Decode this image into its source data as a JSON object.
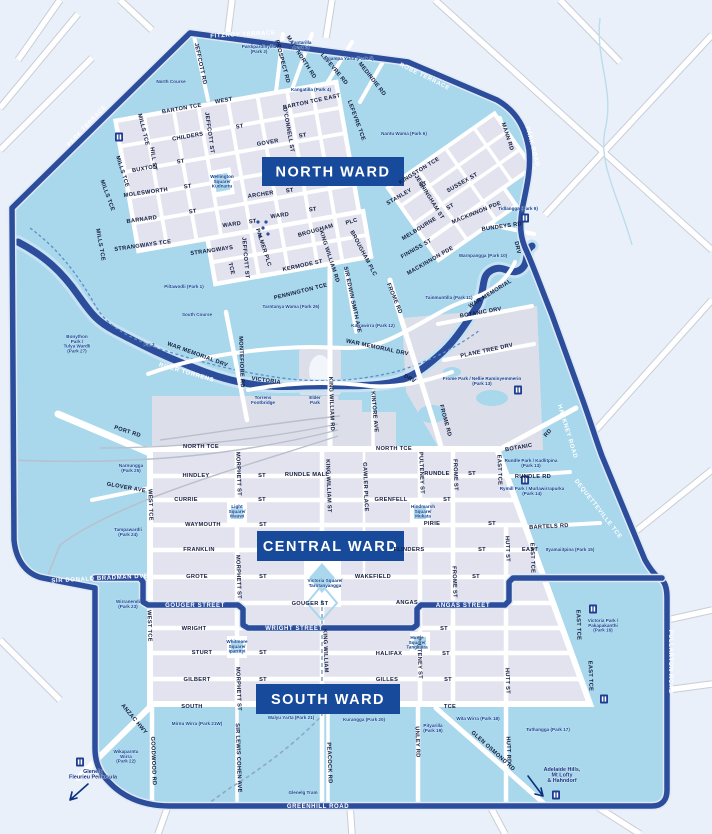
{
  "map": {
    "colors": {
      "outside": "#e9f0f9",
      "parkland": "#a9d7ec",
      "block": "#e2e3ee",
      "infra_grey": "#dcdfe9",
      "boundary_navy": "#2b4d9b",
      "banner_navy": "#174a9b",
      "water_light": "#c6e2f3",
      "label_dark": "#131c3e",
      "park_label": "#0d3e8f"
    },
    "banners": [
      {
        "id": "north",
        "label": "NORTH WARD",
        "x": 262,
        "y": 157,
        "w": 142,
        "h": 29
      },
      {
        "id": "central",
        "label": "CENTRAL WARD",
        "x": 257,
        "y": 531,
        "w": 147,
        "h": 30
      },
      {
        "id": "south",
        "label": "SOUTH WARD",
        "x": 256,
        "y": 684,
        "w": 144,
        "h": 30
      }
    ],
    "boundary_labels": [
      [
        "FITZROY TERRACE",
        243,
        36,
        -3
      ],
      [
        "ROBE TERRACE",
        424,
        78,
        26
      ],
      [
        "PARK ROAD",
        531,
        147,
        75
      ],
      [
        "HACKNEY ROAD",
        566,
        432,
        73
      ],
      [
        "DEQUETTEVILLE TCE",
        597,
        510,
        52
      ],
      [
        "FULLARTON ROAD",
        669,
        662,
        90
      ],
      [
        "GREENHILL ROAD",
        318,
        808,
        0
      ],
      [
        "PARK TERRACE",
        88,
        127,
        -47
      ],
      [
        "SIR DONALD BRADMAN DVE",
        100,
        580,
        -3
      ],
      [
        "GOUGER STREET",
        195,
        607,
        0
      ],
      [
        "WRIGHT STREET",
        294,
        630,
        0
      ],
      [
        "ANGAS STREET",
        463,
        607,
        0
      ],
      [
        "RIVER TORRENS",
        186,
        374,
        16
      ]
    ],
    "streets": [
      [
        "JEFFCOTT RD",
        199,
        64,
        78
      ],
      [
        "PROSPECT RD",
        281,
        62,
        75
      ],
      [
        "MAIN NORTH RD",
        300,
        58,
        57
      ],
      [
        "LEFEVRE RD",
        333,
        70,
        50
      ],
      [
        "MEDINDIE RD",
        371,
        80,
        52
      ],
      [
        "LEFEVRE TCE",
        355,
        121,
        70
      ],
      [
        "BARTON TCE",
        182,
        110,
        -10
      ],
      [
        "WEST",
        224,
        102,
        -10
      ],
      [
        "BARTON TCE EAST",
        312,
        103,
        -12
      ],
      [
        "CHILDERS",
        188,
        138,
        -10
      ],
      [
        "ST",
        240,
        128,
        -10
      ],
      [
        "GOVER",
        268,
        144,
        -10
      ],
      [
        "ST",
        303,
        137,
        -10
      ],
      [
        "O'CONNELL ST",
        287,
        130,
        80
      ],
      [
        "MILLS TCE",
        142,
        130,
        76
      ],
      [
        "HILL ST",
        152,
        159,
        82
      ],
      [
        "MILLS TCE",
        121,
        172,
        72
      ],
      [
        "MILLS TCE",
        106,
        196,
        70
      ],
      [
        "MILLS TCE",
        99,
        245,
        80
      ],
      [
        "BUXTON",
        145,
        170,
        -10
      ],
      [
        "ST",
        181,
        163,
        -10
      ],
      [
        "MOLESWORTH",
        146,
        194,
        -8
      ],
      [
        "ST",
        188,
        188,
        -8
      ],
      [
        "ARCHER",
        261,
        196,
        -8
      ],
      [
        "ST",
        290,
        192,
        -8
      ],
      [
        "BARNARD",
        142,
        221,
        -8
      ],
      [
        "ST",
        193,
        213,
        -8
      ],
      [
        "WARD",
        232,
        226,
        -8
      ],
      [
        "ST",
        253,
        223,
        -8
      ],
      [
        "WARD",
        280,
        217,
        -8
      ],
      [
        "ST",
        313,
        211,
        -8
      ],
      [
        "STRANGWAYS TCE",
        143,
        247,
        -8
      ],
      [
        "STRANGWAYS",
        212,
        252,
        -8
      ],
      [
        "TCE",
        230,
        269,
        75
      ],
      [
        "JEFFCOTT ST",
        208,
        133,
        82
      ],
      [
        "JEFFCOTT ST",
        244,
        258,
        85
      ],
      [
        "PALMER PLC",
        262,
        248,
        72
      ],
      [
        "BROUGHAM",
        316,
        232,
        -16
      ],
      [
        "PLC",
        352,
        223,
        -16
      ],
      [
        "BROUGHAM PLC",
        362,
        254,
        62
      ],
      [
        "KING WILLIAM RD",
        328,
        257,
        72
      ],
      [
        "KERMODE ST",
        303,
        267,
        -12
      ],
      [
        "PENNINGTON TCE",
        301,
        293,
        -14
      ],
      [
        "SIR EDWIN SMITH AVE",
        351,
        300,
        78
      ],
      [
        "FROME RD",
        393,
        299,
        68
      ],
      [
        "FROME RD",
        444,
        421,
        75
      ],
      [
        "KINGSTON TCE",
        420,
        172,
        -32
      ],
      [
        "STANLEY",
        400,
        198,
        -30
      ],
      [
        "ST",
        424,
        186,
        -30
      ],
      [
        "JERNINGHAM ST",
        428,
        198,
        58
      ],
      [
        "SUSSEX ST",
        463,
        184,
        -30
      ],
      [
        "MELBOURNE",
        420,
        230,
        -32
      ],
      [
        "ST",
        451,
        208,
        -30
      ],
      [
        "FINNISS ST",
        417,
        250,
        -30
      ],
      [
        "MACKINNON PDE",
        477,
        214,
        -22
      ],
      [
        "MACKINNON PDE",
        431,
        262,
        -30
      ],
      [
        "BUNDEYS RD",
        502,
        228,
        -8
      ],
      [
        "MANN RD",
        506,
        137,
        72
      ],
      [
        "DRV",
        516,
        248,
        78
      ],
      [
        "WAR MEMORIAL",
        491,
        295,
        -32
      ],
      [
        "WAR MEMORIAL DRV",
        197,
        356,
        20
      ],
      [
        "WAR MEMORIAL DRV",
        377,
        349,
        12
      ],
      [
        "MONTEFIORE RD",
        240,
        362,
        88
      ],
      [
        "KING WILLIAM RD",
        330,
        404,
        88
      ],
      [
        "KINTORE AVE",
        373,
        412,
        85
      ],
      [
        "VICTORIA",
        266,
        382,
        8
      ],
      [
        "DRV",
        409,
        380,
        28
      ],
      [
        "BOTANIC DRV",
        481,
        314,
        -10
      ],
      [
        "PLANE TREE DRV",
        487,
        352,
        -12
      ],
      [
        "BOTANIC",
        519,
        449,
        -10
      ],
      [
        "RD",
        549,
        434,
        -50
      ],
      [
        "PORT RD",
        127,
        433,
        18
      ],
      [
        "GLOVER AVE",
        126,
        489,
        10
      ],
      [
        "NORTH TCE",
        201,
        448,
        0
      ],
      [
        "NORTH TCE",
        394,
        450,
        0
      ],
      [
        "HINDLEY",
        196,
        477,
        0
      ],
      [
        "ST",
        262,
        477,
        0
      ],
      [
        "RUNDLE MALL",
        307,
        476,
        0
      ],
      [
        "RUNDLE",
        437,
        475,
        0
      ],
      [
        "ST",
        472,
        475,
        0
      ],
      [
        "RUNDLE RD",
        533,
        478,
        0
      ],
      [
        "CURRIE",
        186,
        501,
        0
      ],
      [
        "ST",
        262,
        501,
        0
      ],
      [
        "GRENFELL",
        391,
        501,
        0
      ],
      [
        "ST",
        447,
        501,
        0
      ],
      [
        "WAYMOUTH",
        203,
        526,
        0
      ],
      [
        "ST",
        263,
        526,
        0
      ],
      [
        "PIRIE",
        432,
        525,
        0
      ],
      [
        "ST",
        492,
        525,
        0
      ],
      [
        "FRANKLIN",
        199,
        551,
        0
      ],
      [
        "FLINDERS",
        409,
        551,
        0
      ],
      [
        "ST",
        482,
        551,
        0
      ],
      [
        "EAST",
        530,
        551,
        0
      ],
      [
        "GROTE",
        197,
        578,
        0
      ],
      [
        "ST",
        263,
        578,
        0
      ],
      [
        "WAKEFIELD",
        373,
        578,
        0
      ],
      [
        "ST",
        476,
        578,
        0
      ],
      [
        "GOUGER ST",
        310,
        605,
        0
      ],
      [
        "ANGAS",
        407,
        604,
        0
      ],
      [
        "WRIGHT",
        194,
        630,
        0
      ],
      [
        "ST",
        444,
        630,
        0
      ],
      [
        "STURT",
        202,
        654,
        0
      ],
      [
        "ST",
        263,
        654,
        0
      ],
      [
        "HALIFAX",
        389,
        655,
        0
      ],
      [
        "ST",
        446,
        655,
        0
      ],
      [
        "GILBERT",
        197,
        681,
        0
      ],
      [
        "ST",
        263,
        681,
        0
      ],
      [
        "GILLES",
        387,
        681,
        0
      ],
      [
        "ST",
        448,
        681,
        0
      ],
      [
        "SOUTH",
        192,
        708,
        0
      ],
      [
        "TCE",
        450,
        708,
        0
      ],
      [
        "WEST TCE",
        149,
        505,
        88
      ],
      [
        "WEST TCE",
        148,
        626,
        88
      ],
      [
        "MORPHETT ST",
        237,
        474,
        88
      ],
      [
        "MORPHETT ST",
        237,
        577,
        88
      ],
      [
        "MORPHETT ST",
        237,
        689,
        88
      ],
      [
        "KING WILLIAM ST",
        327,
        486,
        88
      ],
      [
        "KING WILLIAM",
        324,
        651,
        88
      ],
      [
        "GAWLER PLACE",
        364,
        487,
        88
      ],
      [
        "PULTENEY ST",
        420,
        473,
        88
      ],
      [
        "PULTENEY ST",
        418,
        658,
        88
      ],
      [
        "FROME ST",
        454,
        475,
        88
      ],
      [
        "FROME ST",
        453,
        582,
        88
      ],
      [
        "EAST TCE",
        498,
        470,
        88
      ],
      [
        "EAST TCE",
        531,
        558,
        88
      ],
      [
        "EAST TCE",
        577,
        625,
        88
      ],
      [
        "EAST TCE",
        589,
        676,
        88
      ],
      [
        "HUTT ST",
        506,
        549,
        88
      ],
      [
        "HUTT ST",
        506,
        681,
        88
      ],
      [
        "HUTT RD",
        507,
        750,
        88
      ],
      [
        "UNLEY RD",
        416,
        742,
        88
      ],
      [
        "GLEN OSMOND RD",
        492,
        752,
        42
      ],
      [
        "PEACOCK RD",
        328,
        763,
        88
      ],
      [
        "SIR LEWIS COHEN AVE",
        237,
        758,
        88
      ],
      [
        "GOODWOOD RD",
        152,
        761,
        88
      ],
      [
        "ANZAC HWY",
        133,
        720,
        50
      ],
      [
        "BARTELS RD",
        549,
        528,
        -3
      ]
    ],
    "parks": [
      {
        "lines": [
          "Pardipardinyilla",
          "(Park 2)"
        ],
        "x": 259,
        "y": 48
      },
      {
        "lines": [
          "Kantarilla",
          "(Park 3)"
        ],
        "x": 301,
        "y": 44
      },
      {
        "lines": [
          "Ngampa Yarta (Park 5)"
        ],
        "x": 349,
        "y": 60
      },
      {
        "lines": [
          "Kangatilla (Park 4)"
        ],
        "x": 311,
        "y": 91
      },
      {
        "lines": [
          "North Course"
        ],
        "x": 171,
        "y": 83
      },
      {
        "lines": [
          "Nantu Wama (Park 6)"
        ],
        "x": 404,
        "y": 135
      },
      {
        "lines": [
          "Tidlangga (Park 9)"
        ],
        "x": 518,
        "y": 210
      },
      {
        "lines": [
          "Warnpangga (Park 10)"
        ],
        "x": 483,
        "y": 257
      },
      {
        "lines": [
          "Piltawodli (Park 1)"
        ],
        "x": 184,
        "y": 288
      },
      {
        "lines": [
          "South Course"
        ],
        "x": 197,
        "y": 316
      },
      {
        "lines": [
          "Bonython",
          "Park /",
          "Tulya Wardli",
          "(Park 27)"
        ],
        "x": 77,
        "y": 338
      },
      {
        "lines": [
          "Par 3"
        ],
        "x": 149,
        "y": 346
      },
      {
        "lines": [
          "Tarntanya Wama (Park 26)"
        ],
        "x": 291,
        "y": 308
      },
      {
        "lines": [
          "Elder",
          "Park"
        ],
        "x": 315,
        "y": 399
      },
      {
        "lines": [
          "Torrens",
          "Footbridge"
        ],
        "x": 263,
        "y": 399
      },
      {
        "lines": [
          "Karrawirra (Park 12)"
        ],
        "x": 373,
        "y": 327
      },
      {
        "lines": [
          "Tainmuntilla (Park 11)"
        ],
        "x": 449,
        "y": 299
      },
      {
        "lines": [
          "Frome Park / Nellie Raminyemmerin",
          "(Park 13)"
        ],
        "x": 482,
        "y": 380
      },
      {
        "lines": [
          "Rundle Park / Kadlitpina",
          "(Park 13)"
        ],
        "x": 531,
        "y": 462
      },
      {
        "lines": [
          "Rymill Park / Murlawirrapurka",
          "(Park 14)"
        ],
        "x": 532,
        "y": 490
      },
      {
        "lines": [
          "Ityamaiitpina (Park 15)"
        ],
        "x": 570,
        "y": 551
      },
      {
        "lines": [
          "Victoria Park /",
          "Pakapakanthi",
          "(Park 16)"
        ],
        "x": 603,
        "y": 622
      },
      {
        "lines": [
          "Narnungga",
          "(Park 25)"
        ],
        "x": 131,
        "y": 467
      },
      {
        "lines": [
          "Tampawardli",
          "(Park 24)"
        ],
        "x": 128,
        "y": 531
      },
      {
        "lines": [
          "Wirranendi",
          "(Park 23)"
        ],
        "x": 128,
        "y": 603
      },
      {
        "lines": [
          "Mirnu Wirra (Park 21W)"
        ],
        "x": 197,
        "y": 725
      },
      {
        "lines": [
          "Walyu Yarta (Park 21)"
        ],
        "x": 291,
        "y": 719
      },
      {
        "lines": [
          "Kurangga (Park 20)"
        ],
        "x": 364,
        "y": 721
      },
      {
        "lines": [
          "Pityarilla",
          "(Park 19)"
        ],
        "x": 433,
        "y": 727
      },
      {
        "lines": [
          "Wita Wirra (Park 18)"
        ],
        "x": 478,
        "y": 720
      },
      {
        "lines": [
          "Tuthangga (Park 17)"
        ],
        "x": 548,
        "y": 731
      },
      {
        "lines": [
          "Wikaparntu",
          "Wirra",
          "(Park 22)"
        ],
        "x": 126,
        "y": 753
      },
      {
        "lines": [
          "Wellington",
          "Square/",
          "Kudnartu"
        ],
        "x": 222,
        "y": 178
      },
      {
        "lines": [
          "Light",
          "Square/",
          "Wauwi"
        ],
        "x": 237,
        "y": 508
      },
      {
        "lines": [
          "Hindmarsh",
          "Square/",
          "Mukata"
        ],
        "x": 423,
        "y": 508
      },
      {
        "lines": [
          "Victoria Square/",
          "Tarntanyangga"
        ],
        "x": 325,
        "y": 582
      },
      {
        "lines": [
          "Whitmore",
          "Square/",
          "Iparrityi"
        ],
        "x": 237,
        "y": 643
      },
      {
        "lines": [
          "Hurtle",
          "Square/",
          "Tangkaira"
        ],
        "x": 417,
        "y": 639
      },
      {
        "lines": [
          "Glenelg Tram"
        ],
        "x": 303,
        "y": 794
      }
    ],
    "destinations": [
      {
        "lines": [
          "Glenelg",
          "Fleurieu Peninsula"
        ],
        "x": 93,
        "y": 773
      },
      {
        "lines": [
          "Adelaide Hills,",
          "Mt Lofty",
          "& Hahndorf"
        ],
        "x": 562,
        "y": 771
      }
    ],
    "icons": [
      {
        "name": "landmark-icon",
        "x": 119,
        "y": 137
      },
      {
        "name": "landmark-icon",
        "x": 525,
        "y": 218
      },
      {
        "name": "landmark-icon",
        "x": 518,
        "y": 390
      },
      {
        "name": "landmark-icon",
        "x": 525,
        "y": 480
      },
      {
        "name": "landmark-icon",
        "x": 593,
        "y": 609
      },
      {
        "name": "landmark-icon",
        "x": 604,
        "y": 699
      },
      {
        "name": "landmark-icon",
        "x": 80,
        "y": 762
      },
      {
        "name": "landmark-icon",
        "x": 556,
        "y": 795
      }
    ]
  }
}
